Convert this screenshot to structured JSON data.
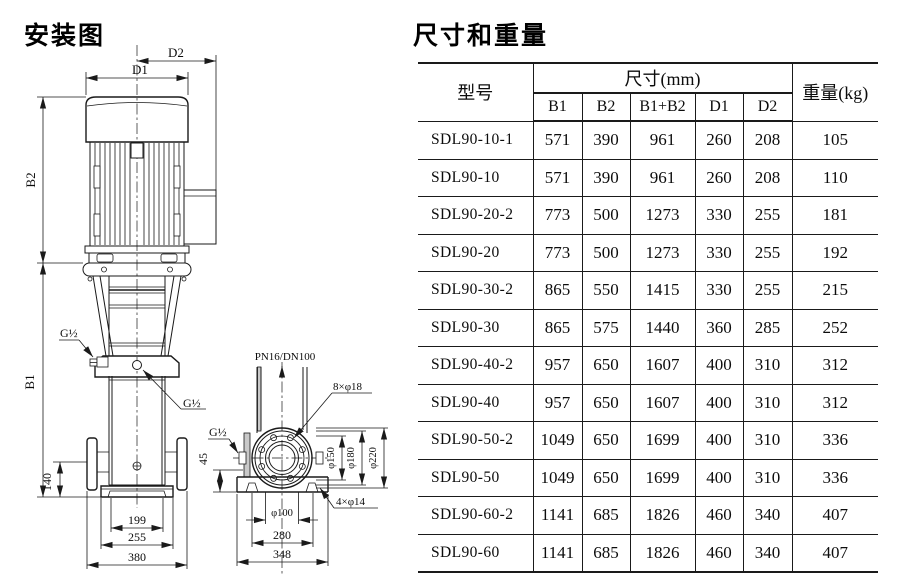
{
  "diagram": {
    "title": "安装图",
    "front_view": {
      "d2": "D2",
      "d1": "D1",
      "b2": "B2",
      "b1": "B1",
      "g_half_top": "G½",
      "g_half_mid": "G½",
      "dim_140": "140",
      "dim_199": "199",
      "dim_255": "255",
      "dim_380": "380"
    },
    "side_view": {
      "flange_spec": "PN16/DN100",
      "bolt_top": "8×φ18",
      "g_half": "G½",
      "dim_45": "45",
      "phi_150": "φ150",
      "phi_180": "φ180",
      "phi_220": "φ220",
      "bolt_base": "4×φ14",
      "phi_100": "φ100",
      "dim_280": "280",
      "dim_348": "348"
    }
  },
  "table": {
    "title": "尺寸和重量",
    "headers": {
      "model": "型号",
      "dims_group": "尺寸(mm)",
      "b1": "B1",
      "b2": "B2",
      "b1b2": "B1+B2",
      "d1": "D1",
      "d2": "D2",
      "weight": "重量(kg)"
    },
    "rows": [
      [
        "SDL90-10-1",
        "571",
        "390",
        "961",
        "260",
        "208",
        "105"
      ],
      [
        "SDL90-10",
        "571",
        "390",
        "961",
        "260",
        "208",
        "110"
      ],
      [
        "SDL90-20-2",
        "773",
        "500",
        "1273",
        "330",
        "255",
        "181"
      ],
      [
        "SDL90-20",
        "773",
        "500",
        "1273",
        "330",
        "255",
        "192"
      ],
      [
        "SDL90-30-2",
        "865",
        "550",
        "1415",
        "330",
        "255",
        "215"
      ],
      [
        "SDL90-30",
        "865",
        "575",
        "1440",
        "360",
        "285",
        "252"
      ],
      [
        "SDL90-40-2",
        "957",
        "650",
        "1607",
        "400",
        "310",
        "312"
      ],
      [
        "SDL90-40",
        "957",
        "650",
        "1607",
        "400",
        "310",
        "312"
      ],
      [
        "SDL90-50-2",
        "1049",
        "650",
        "1699",
        "400",
        "310",
        "336"
      ],
      [
        "SDL90-50",
        "1049",
        "650",
        "1699",
        "400",
        "310",
        "336"
      ],
      [
        "SDL90-60-2",
        "1141",
        "685",
        "1826",
        "460",
        "340",
        "407"
      ],
      [
        "SDL90-60",
        "1141",
        "685",
        "1826",
        "460",
        "340",
        "407"
      ]
    ]
  }
}
